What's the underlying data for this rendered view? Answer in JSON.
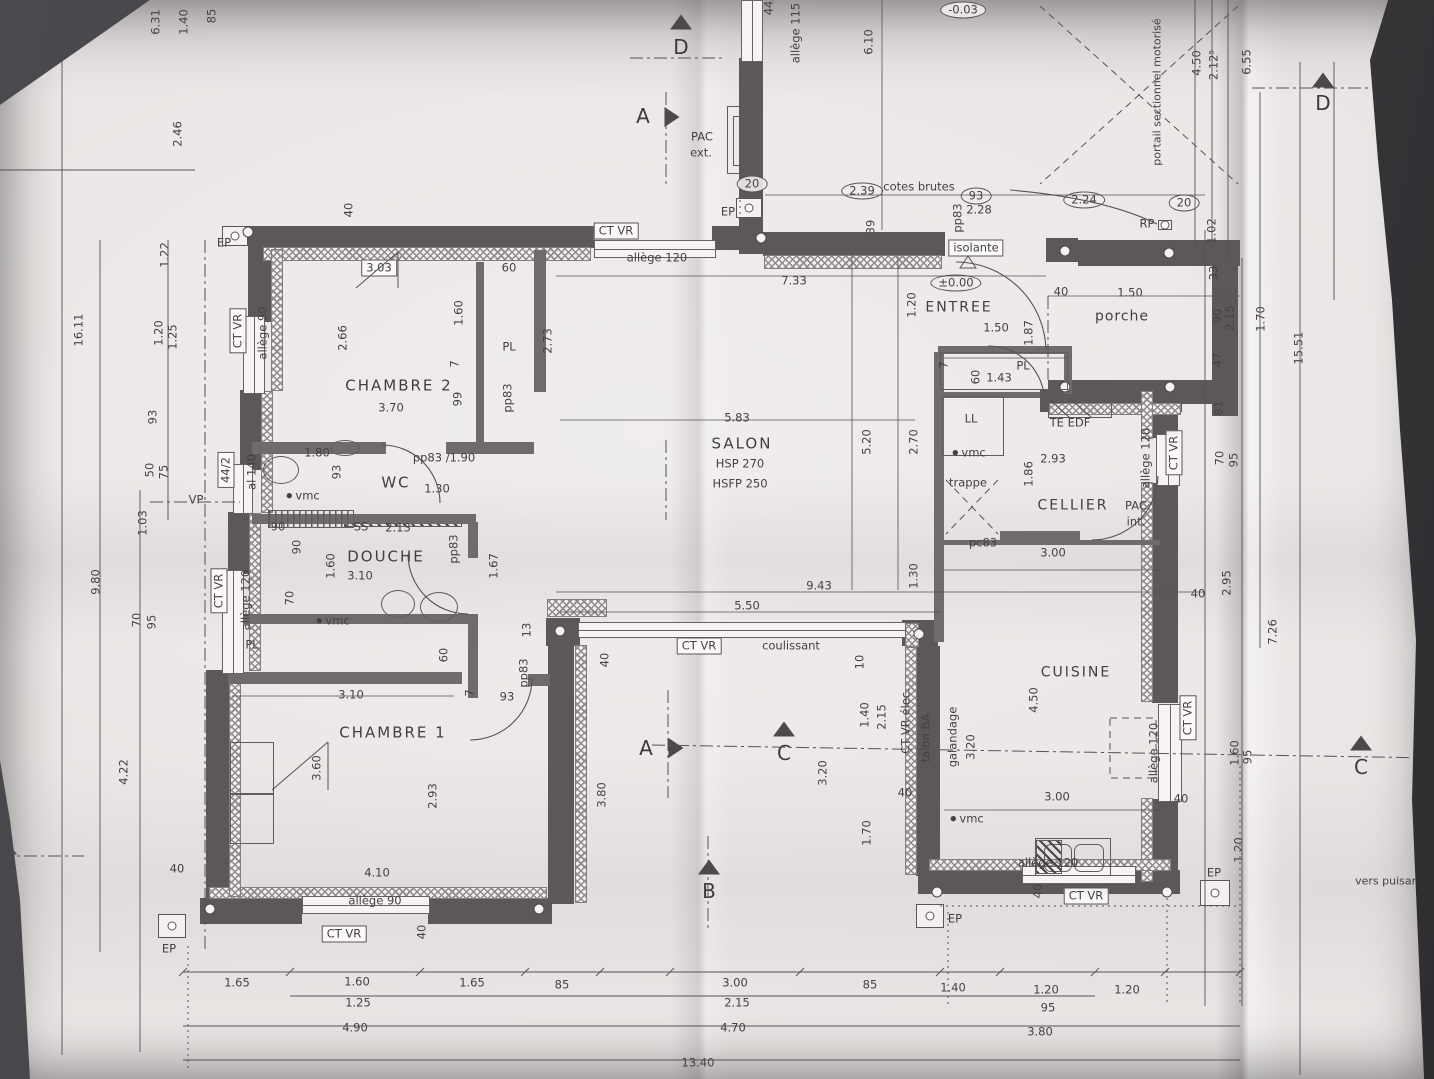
{
  "colors": {
    "background": "#3f3f43",
    "paper": "#e9e5e4",
    "ink": "#444145",
    "wall": "#5b575a"
  },
  "room_labels": [
    {
      "t": "CHAMBRE 2",
      "x": 399,
      "y": 386
    },
    {
      "t": "WC",
      "x": 396,
      "y": 483
    },
    {
      "t": "DOUCHE",
      "x": 386,
      "y": 557
    },
    {
      "t": "CHAMBRE 1",
      "x": 393,
      "y": 733
    },
    {
      "t": "SALON",
      "x": 742,
      "y": 444
    },
    {
      "t": "ENTREE",
      "x": 959,
      "y": 308
    },
    {
      "t": "porche",
      "x": 1122,
      "y": 317
    },
    {
      "t": "CELLIER",
      "x": 1073,
      "y": 506
    },
    {
      "t": "CUISINE",
      "x": 1076,
      "y": 673
    }
  ],
  "salon_hsp": "HSP 270",
  "salon_hsfp": "HSFP 250",
  "labels": [
    [
      "6.31",
      156,
      22,
      1,
      0
    ],
    [
      "1.40",
      184,
      22,
      1,
      0
    ],
    [
      "85",
      212,
      16,
      1,
      0
    ],
    [
      "2.46",
      178,
      134,
      1,
      0
    ],
    [
      "16.11",
      79,
      330,
      1,
      0
    ],
    [
      "1.22",
      165,
      255,
      1,
      0
    ],
    [
      "1.20",
      159,
      333,
      1,
      0
    ],
    [
      "1.25",
      173,
      337,
      1,
      0
    ],
    [
      "93",
      153,
      417,
      1,
      0
    ],
    [
      "50",
      150,
      470,
      1,
      0
    ],
    [
      "75",
      164,
      472,
      1,
      0
    ],
    [
      "1.03",
      143,
      523,
      1,
      0
    ],
    [
      "9.80",
      96,
      582,
      1,
      0
    ],
    [
      "70",
      137,
      620,
      1,
      0
    ],
    [
      "95",
      152,
      622,
      1,
      0
    ],
    [
      "4.22",
      124,
      772,
      1,
      0
    ],
    [
      "40",
      177,
      869,
      0,
      0
    ],
    [
      "EP",
      169,
      949,
      0,
      0
    ],
    [
      "CT VR",
      238,
      331,
      1,
      1
    ],
    [
      "allège 90",
      263,
      333,
      1,
      0
    ],
    [
      "44/2",
      226,
      470,
      1,
      1
    ],
    [
      "al 140",
      252,
      472,
      1,
      0
    ],
    [
      "VP",
      196,
      500,
      0,
      0
    ],
    [
      "CT VR",
      219,
      591,
      1,
      1
    ],
    [
      "allège 120",
      246,
      600,
      1,
      0
    ],
    [
      "PL",
      252,
      645,
      0,
      0
    ],
    [
      "70",
      290,
      598,
      1,
      0
    ],
    [
      "90",
      278,
      527,
      0,
      0
    ],
    [
      "90",
      297,
      547,
      1,
      0
    ],
    [
      "EP",
      224,
      243,
      0,
      0
    ],
    [
      "40",
      349,
      210,
      1,
      0
    ],
    [
      "3.03",
      379,
      268,
      0,
      1
    ],
    [
      "60",
      509,
      268,
      0,
      0
    ],
    [
      "2.66",
      343,
      338,
      1,
      0
    ],
    [
      "1.60",
      459,
      313,
      1,
      0
    ],
    [
      "PL",
      509,
      347,
      0,
      0
    ],
    [
      "2.73",
      548,
      341,
      1,
      0
    ],
    [
      "3.70",
      391,
      408,
      0,
      0
    ],
    [
      "7",
      455,
      364,
      1,
      0
    ],
    [
      "99",
      458,
      399,
      1,
      0
    ],
    [
      "pp83",
      508,
      398,
      1,
      0
    ],
    [
      "1.80",
      317,
      453,
      0,
      0
    ],
    [
      "pp83 /1.90",
      444,
      458,
      0,
      0
    ],
    [
      "93",
      337,
      472,
      1,
      0
    ],
    [
      "1.30",
      437,
      489,
      0,
      0
    ],
    [
      "vmc",
      303,
      496,
      0,
      3
    ],
    [
      "SS",
      361,
      527,
      0,
      0
    ],
    [
      "2.13",
      398,
      528,
      0,
      0
    ],
    [
      "3.10",
      360,
      576,
      0,
      0
    ],
    [
      "1.60",
      331,
      566,
      1,
      0
    ],
    [
      "pp83",
      454,
      549,
      1,
      0
    ],
    [
      "1.67",
      494,
      566,
      1,
      0
    ],
    [
      "vmc",
      333,
      621,
      0,
      3
    ],
    [
      "60",
      444,
      655,
      1,
      0
    ],
    [
      "3.10",
      351,
      695,
      0,
      0
    ],
    [
      "7",
      470,
      693,
      1,
      0
    ],
    [
      "93",
      507,
      697,
      0,
      0
    ],
    [
      "pp83",
      524,
      673,
      1,
      0
    ],
    [
      "13",
      527,
      630,
      1,
      0
    ],
    [
      "3.60",
      317,
      768,
      1,
      0
    ],
    [
      "2.93",
      433,
      796,
      1,
      0
    ],
    [
      "4.10",
      377,
      873,
      0,
      0
    ],
    [
      "allège 90",
      375,
      901,
      0,
      0
    ],
    [
      "CT VR",
      344,
      934,
      0,
      1
    ],
    [
      "40",
      422,
      932,
      1,
      0
    ],
    [
      "5.83",
      737,
      418,
      0,
      0
    ],
    [
      "5.20",
      867,
      442,
      1,
      0
    ],
    [
      "2.70",
      914,
      442,
      1,
      0
    ],
    [
      "9.43",
      819,
      586,
      0,
      0
    ],
    [
      "5.50",
      747,
      606,
      0,
      0
    ],
    [
      "1.30",
      914,
      576,
      1,
      0
    ],
    [
      "CT VR",
      699,
      646,
      0,
      1
    ],
    [
      "coulissant",
      791,
      646,
      0,
      0
    ],
    [
      "40",
      605,
      660,
      1,
      0
    ],
    [
      "3.80",
      602,
      795,
      1,
      0
    ],
    [
      "3.20",
      823,
      773,
      1,
      0
    ],
    [
      "1.40",
      865,
      715,
      1,
      0
    ],
    [
      "2.15",
      882,
      717,
      1,
      0
    ],
    [
      "CT VR élec.",
      906,
      721,
      1,
      0
    ],
    [
      "talon BA",
      926,
      738,
      1,
      0
    ],
    [
      "galandage",
      953,
      737,
      1,
      0
    ],
    [
      "10",
      860,
      662,
      1,
      0
    ],
    [
      "1.70",
      867,
      833,
      1,
      0
    ],
    [
      "40",
      905,
      793,
      0,
      0
    ],
    [
      "PAC",
      702,
      137,
      0,
      0
    ],
    [
      "ext.",
      701,
      153,
      0,
      0
    ],
    [
      "44/",
      769,
      6,
      1,
      0
    ],
    [
      "allège 115",
      796,
      33,
      1,
      0
    ],
    [
      "6.10",
      869,
      42,
      1,
      0
    ],
    [
      "-0.03",
      963,
      10,
      0,
      2
    ],
    [
      "20",
      752,
      184,
      0,
      2
    ],
    [
      "2.39",
      862,
      191,
      0,
      2
    ],
    [
      "cotes brutes",
      919,
      187,
      0,
      0
    ],
    [
      "93",
      976,
      196,
      0,
      2
    ],
    [
      "2.28",
      979,
      210,
      0,
      0
    ],
    [
      "EP",
      728,
      212,
      0,
      0
    ],
    [
      "39",
      871,
      227,
      1,
      0
    ],
    [
      "pp83",
      958,
      218,
      1,
      0
    ],
    [
      "isolante",
      976,
      248,
      0,
      1
    ],
    [
      "CT VR",
      616,
      231,
      0,
      1
    ],
    [
      "allège 120",
      657,
      258,
      0,
      0
    ],
    [
      "7.33",
      794,
      281,
      0,
      0
    ],
    [
      "±0.00",
      956,
      283,
      0,
      2
    ],
    [
      "1.20",
      912,
      305,
      1,
      0
    ],
    [
      "1.50",
      996,
      328,
      0,
      0
    ],
    [
      "1.87",
      1029,
      333,
      1,
      0
    ],
    [
      "40",
      1061,
      292,
      0,
      0
    ],
    [
      "1.50",
      1130,
      293,
      0,
      0
    ],
    [
      "2.24",
      1084,
      200,
      0,
      2
    ],
    [
      "RP",
      1147,
      224,
      0,
      0
    ],
    [
      "20",
      1184,
      203,
      0,
      2
    ],
    [
      "portail sectionnel motorisé",
      1157,
      92,
      1,
      4
    ],
    [
      "4.50",
      1197,
      63,
      1,
      0
    ],
    [
      "2.12⁵",
      1214,
      65,
      1,
      0
    ],
    [
      "6.55",
      1247,
      62,
      1,
      0
    ],
    [
      "1.02",
      1212,
      231,
      1,
      0
    ],
    [
      "33",
      1214,
      273,
      1,
      0
    ],
    [
      "PL",
      1023,
      366,
      0,
      0
    ],
    [
      "60",
      976,
      377,
      1,
      0
    ],
    [
      "1.43",
      999,
      378,
      0,
      0
    ],
    [
      "7",
      944,
      365,
      1,
      0
    ],
    [
      "LL",
      971,
      419,
      0,
      0
    ],
    [
      "TE EDF",
      1070,
      423,
      0,
      0
    ],
    [
      "vmc",
      969,
      453,
      0,
      3
    ],
    [
      "2.93",
      1053,
      459,
      0,
      0
    ],
    [
      "1.86",
      1029,
      474,
      1,
      0
    ],
    [
      "trappe",
      968,
      483,
      0,
      0
    ],
    [
      "PAC",
      1136,
      506,
      0,
      0
    ],
    [
      "int.",
      1136,
      522,
      0,
      0
    ],
    [
      "allège 120",
      1146,
      458,
      1,
      0
    ],
    [
      "CT VR",
      1174,
      453,
      1,
      1
    ],
    [
      "pc83",
      983,
      543,
      0,
      0
    ],
    [
      "3.00",
      1053,
      553,
      0,
      0
    ],
    [
      "40",
      1198,
      594,
      0,
      0
    ],
    [
      "90",
      1218,
      316,
      1,
      0
    ],
    [
      "2.15",
      1230,
      318,
      1,
      0
    ],
    [
      "1.70",
      1261,
      319,
      1,
      0
    ],
    [
      "15.51",
      1299,
      348,
      1,
      0
    ],
    [
      "47",
      1218,
      360,
      1,
      0
    ],
    [
      "81",
      1219,
      408,
      1,
      0
    ],
    [
      "70",
      1220,
      458,
      1,
      0
    ],
    [
      "95",
      1234,
      460,
      1,
      0
    ],
    [
      "2.95",
      1227,
      583,
      1,
      0
    ],
    [
      "7.26",
      1273,
      632,
      1,
      0
    ],
    [
      "1.60",
      1235,
      753,
      1,
      0
    ],
    [
      "95",
      1248,
      757,
      1,
      0
    ],
    [
      "1.20",
      1239,
      850,
      1,
      0
    ],
    [
      "EP",
      1214,
      873,
      0,
      0
    ],
    [
      "vers puisard",
      1389,
      881,
      0,
      4
    ],
    [
      "4.50",
      1034,
      700,
      1,
      0
    ],
    [
      "3.20",
      971,
      747,
      1,
      0
    ],
    [
      "3.00",
      1057,
      797,
      0,
      0
    ],
    [
      "vmc",
      967,
      819,
      0,
      3
    ],
    [
      "allège 120",
      1154,
      753,
      1,
      0
    ],
    [
      "CT VR",
      1188,
      718,
      1,
      1
    ],
    [
      "40",
      1181,
      799,
      0,
      0
    ],
    [
      "allège 120",
      1048,
      863,
      0,
      0
    ],
    [
      "40",
      1038,
      891,
      1,
      0
    ],
    [
      "CT VR",
      1086,
      896,
      0,
      1
    ],
    [
      "EP",
      955,
      919,
      0,
      0
    ],
    [
      "1.65",
      237,
      983,
      0,
      0
    ],
    [
      "1.60",
      357,
      982,
      0,
      0
    ],
    [
      "1.25",
      358,
      1003,
      0,
      0
    ],
    [
      "1.65",
      472,
      983,
      0,
      0
    ],
    [
      "85",
      562,
      985,
      0,
      0
    ],
    [
      "4.90",
      355,
      1028,
      0,
      0
    ],
    [
      "3.00",
      735,
      983,
      0,
      0
    ],
    [
      "2.15",
      737,
      1003,
      0,
      0
    ],
    [
      "85",
      870,
      985,
      0,
      0
    ],
    [
      "1.40",
      953,
      988,
      0,
      0
    ],
    [
      "1.20",
      1046,
      990,
      0,
      0
    ],
    [
      "95",
      1048,
      1008,
      0,
      0
    ],
    [
      "1.20",
      1127,
      990,
      0,
      0
    ],
    [
      "4.70",
      733,
      1028,
      0,
      0
    ],
    [
      "3.80",
      1040,
      1032,
      0,
      0
    ],
    [
      "13.40",
      698,
      1063,
      0,
      0
    ]
  ],
  "section_markers": [
    {
      "letter": "D",
      "lx": 681,
      "ly": 47,
      "dir": "up",
      "tx": 681,
      "ty": 22
    },
    {
      "letter": "A",
      "lx": 643,
      "ly": 116,
      "dir": "right",
      "tx": 672,
      "ty": 117
    },
    {
      "letter": "D",
      "lx": 1323,
      "ly": 103,
      "dir": "up",
      "tx": 1323,
      "ty": 80
    },
    {
      "letter": "A",
      "lx": 646,
      "ly": 748,
      "dir": "right",
      "tx": 676,
      "ty": 748
    },
    {
      "letter": "C",
      "lx": 784,
      "ly": 753,
      "dir": "up",
      "tx": 784,
      "ty": 729
    },
    {
      "letter": "B",
      "lx": 709,
      "ly": 891,
      "dir": "up",
      "tx": 709,
      "ty": 867
    },
    {
      "letter": "C",
      "lx": 1361,
      "ly": 767,
      "dir": "up",
      "tx": 1361,
      "ty": 743
    },
    {
      "letter": "B",
      "lx": -4,
      "ly": 872,
      "dir": "up",
      "tx": 6,
      "ty": 847
    }
  ]
}
